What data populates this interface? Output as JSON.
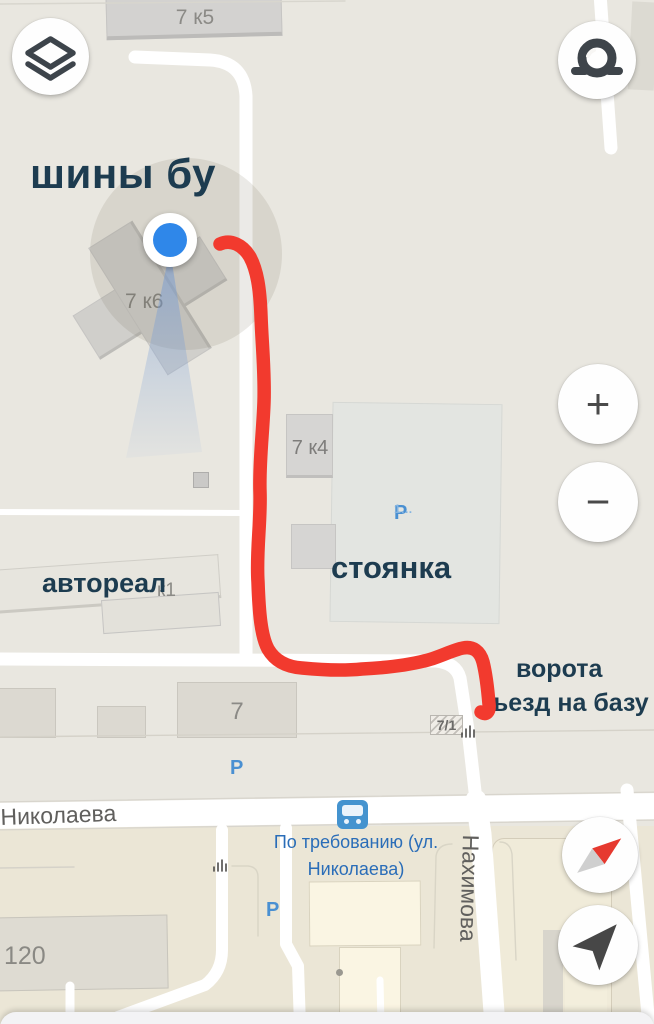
{
  "annotations": {
    "tires": "шины бу",
    "parking_lot": "стоянка",
    "avtoreal": "автореал",
    "gate_line1": "ворота",
    "gate_line2": "ъезд на базу"
  },
  "buildings": {
    "b7k5": "7 к5",
    "b7k6": "7 к6",
    "b7k4": "7 к4",
    "k1": "к1",
    "b7": "7",
    "b7_1": "7/1",
    "b120": "120"
  },
  "streets": {
    "nikolaeva": "Николаева",
    "nakhimova": "Нахимова"
  },
  "transit_stop": {
    "line1": "По требованию (ул.",
    "line2": "Николаева)"
  },
  "parking": {
    "symbol": "P",
    "p1_suffix": "1…"
  },
  "controls": {
    "zoom_in": "+",
    "zoom_out": "−"
  },
  "colors": {
    "route": "#f23a2e",
    "location_blue": "#2f87e9",
    "annotation_text": "#1d3c50",
    "transit_blue": "#2a6db8",
    "parking_blue": "#4a90d2"
  }
}
